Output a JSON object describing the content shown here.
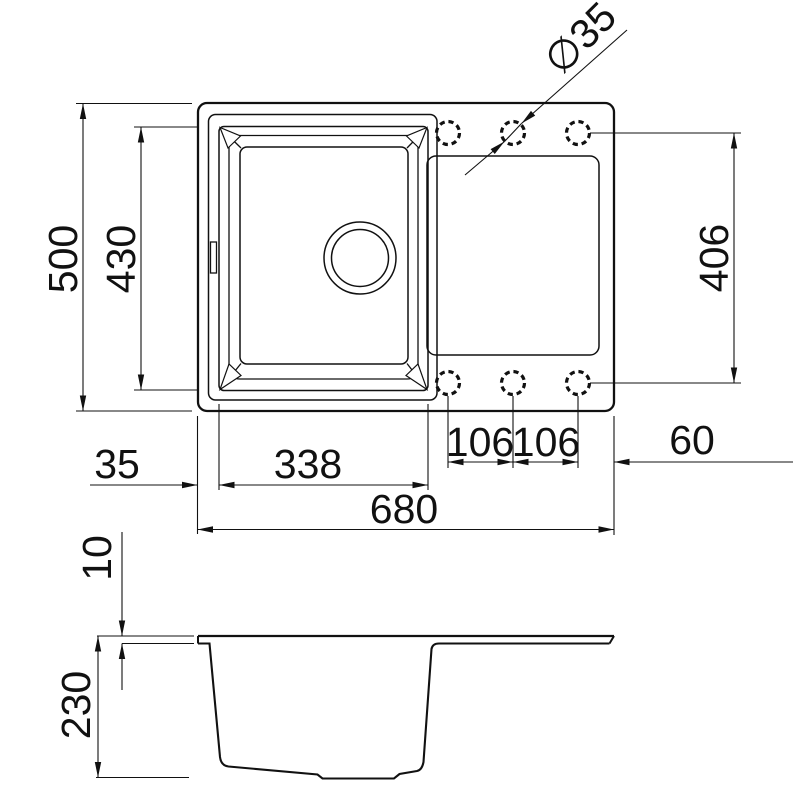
{
  "drawing": {
    "type": "kitchen-sink-technical-drawing",
    "views": {
      "top": "top-view",
      "side": "side-section-view"
    },
    "colors": {
      "line": "#111111",
      "background": "#ffffff"
    },
    "dimensions": {
      "overall_depth": "500",
      "bowl_depth": "430",
      "hole_rows_spacing": "406",
      "left_offset": "35",
      "bowl_width": "338",
      "overall_width": "680",
      "hole_pitch_1": "106",
      "hole_pitch_2": "106",
      "hole_right_offset": "60",
      "hole_diameter": "∅35",
      "rim_thickness": "10",
      "bowl_height": "230"
    },
    "features": {
      "tap_hole_count": 6,
      "drain": "drain-circle",
      "overflow": "overflow-notch"
    }
  }
}
